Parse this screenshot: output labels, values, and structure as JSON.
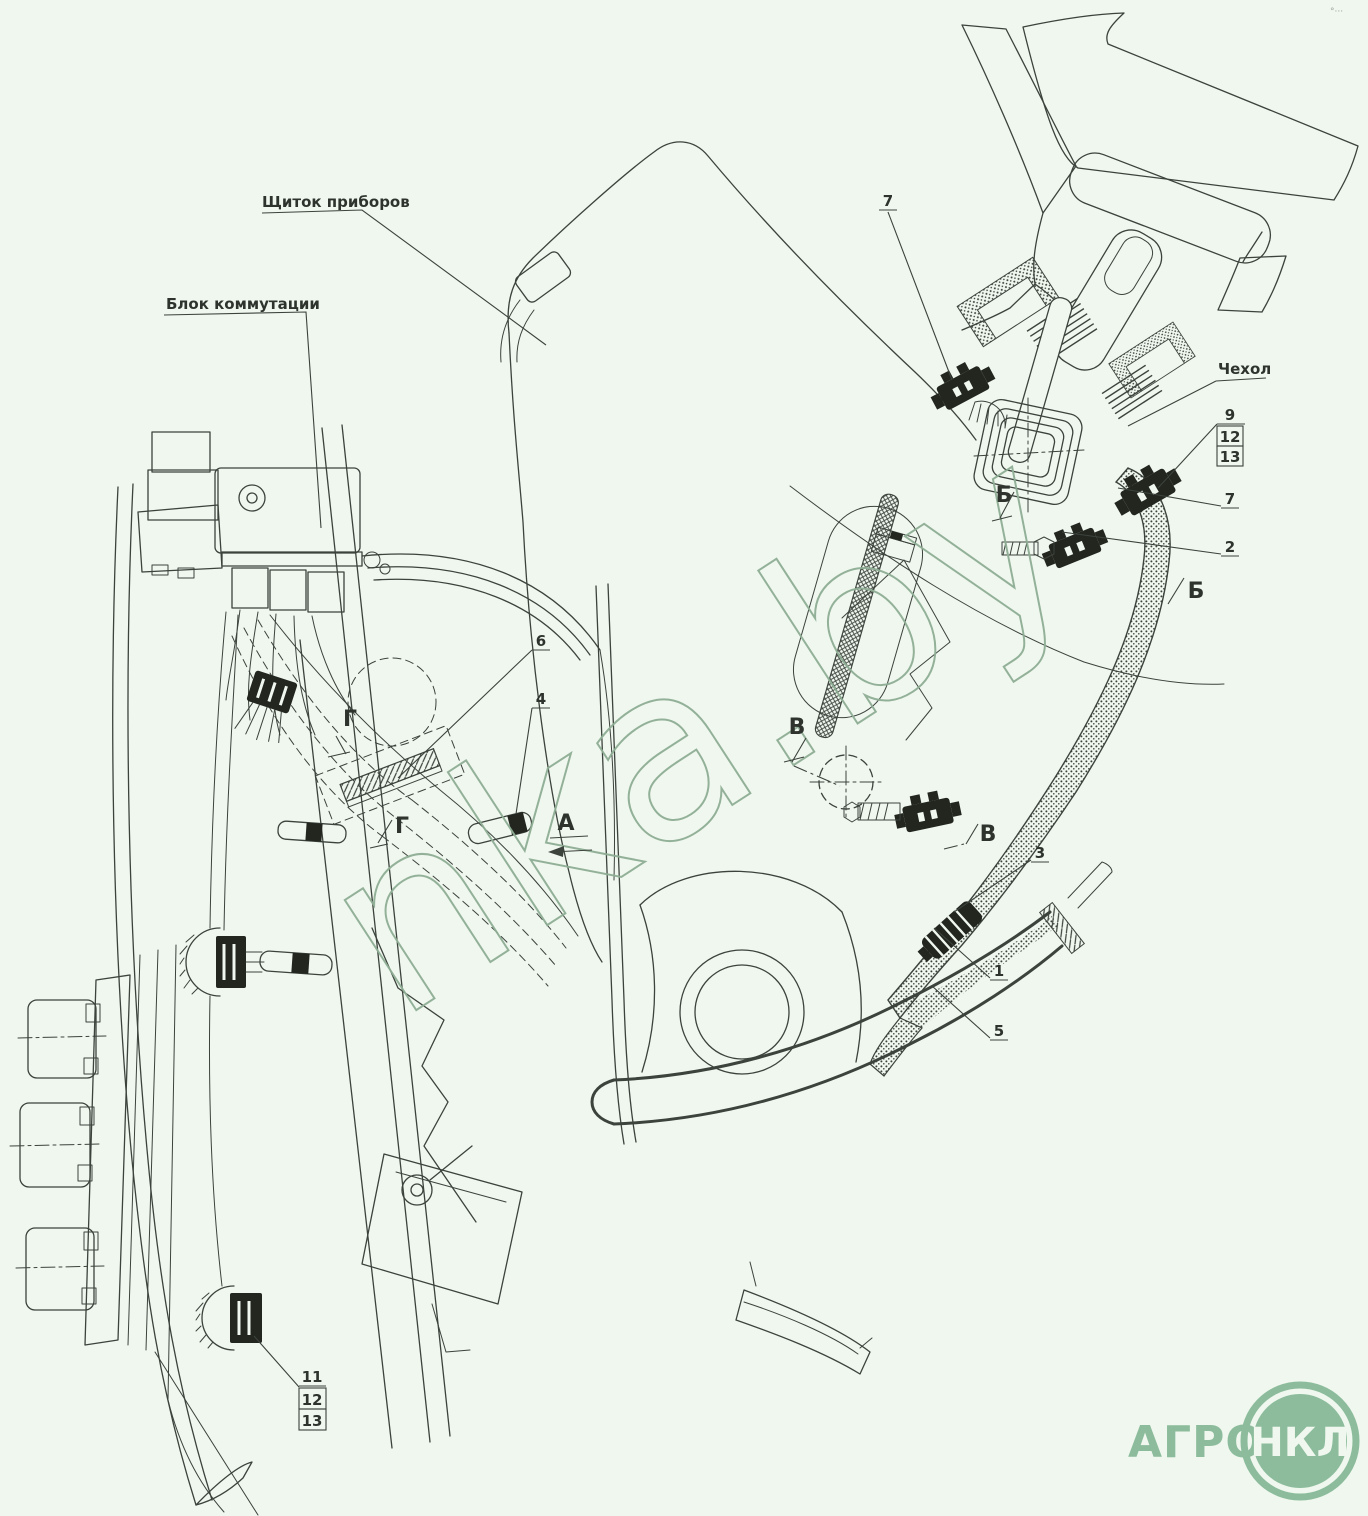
{
  "page": {
    "bg": "#eff7ef",
    "ink": "#3c423c",
    "accent_green": "#8cbc9b"
  },
  "annotations": {
    "instrument_panel": "Щиток приборов",
    "commutation_block": "Блок коммутации",
    "cover": "Чехол"
  },
  "callouts": {
    "top7": "7",
    "r9": "9",
    "r12": "12",
    "r13": "13",
    "r7": "7",
    "r2": "2",
    "r3": "3",
    "r1": "1",
    "r5": "5",
    "c6": "6",
    "c4": "4",
    "l11": "11",
    "l12": "12",
    "l13": "13"
  },
  "view_marks": {
    "b_upper": "Б",
    "b_lower": "Б",
    "v_upper": "В",
    "v_lower": "В",
    "g_upper": "Г",
    "g_lower": "Г",
    "a_view": "А"
  },
  "watermark": "nka.by",
  "logo": {
    "word": "АГРО",
    "badge": "НКЛ"
  },
  "corner_marks": "°···"
}
